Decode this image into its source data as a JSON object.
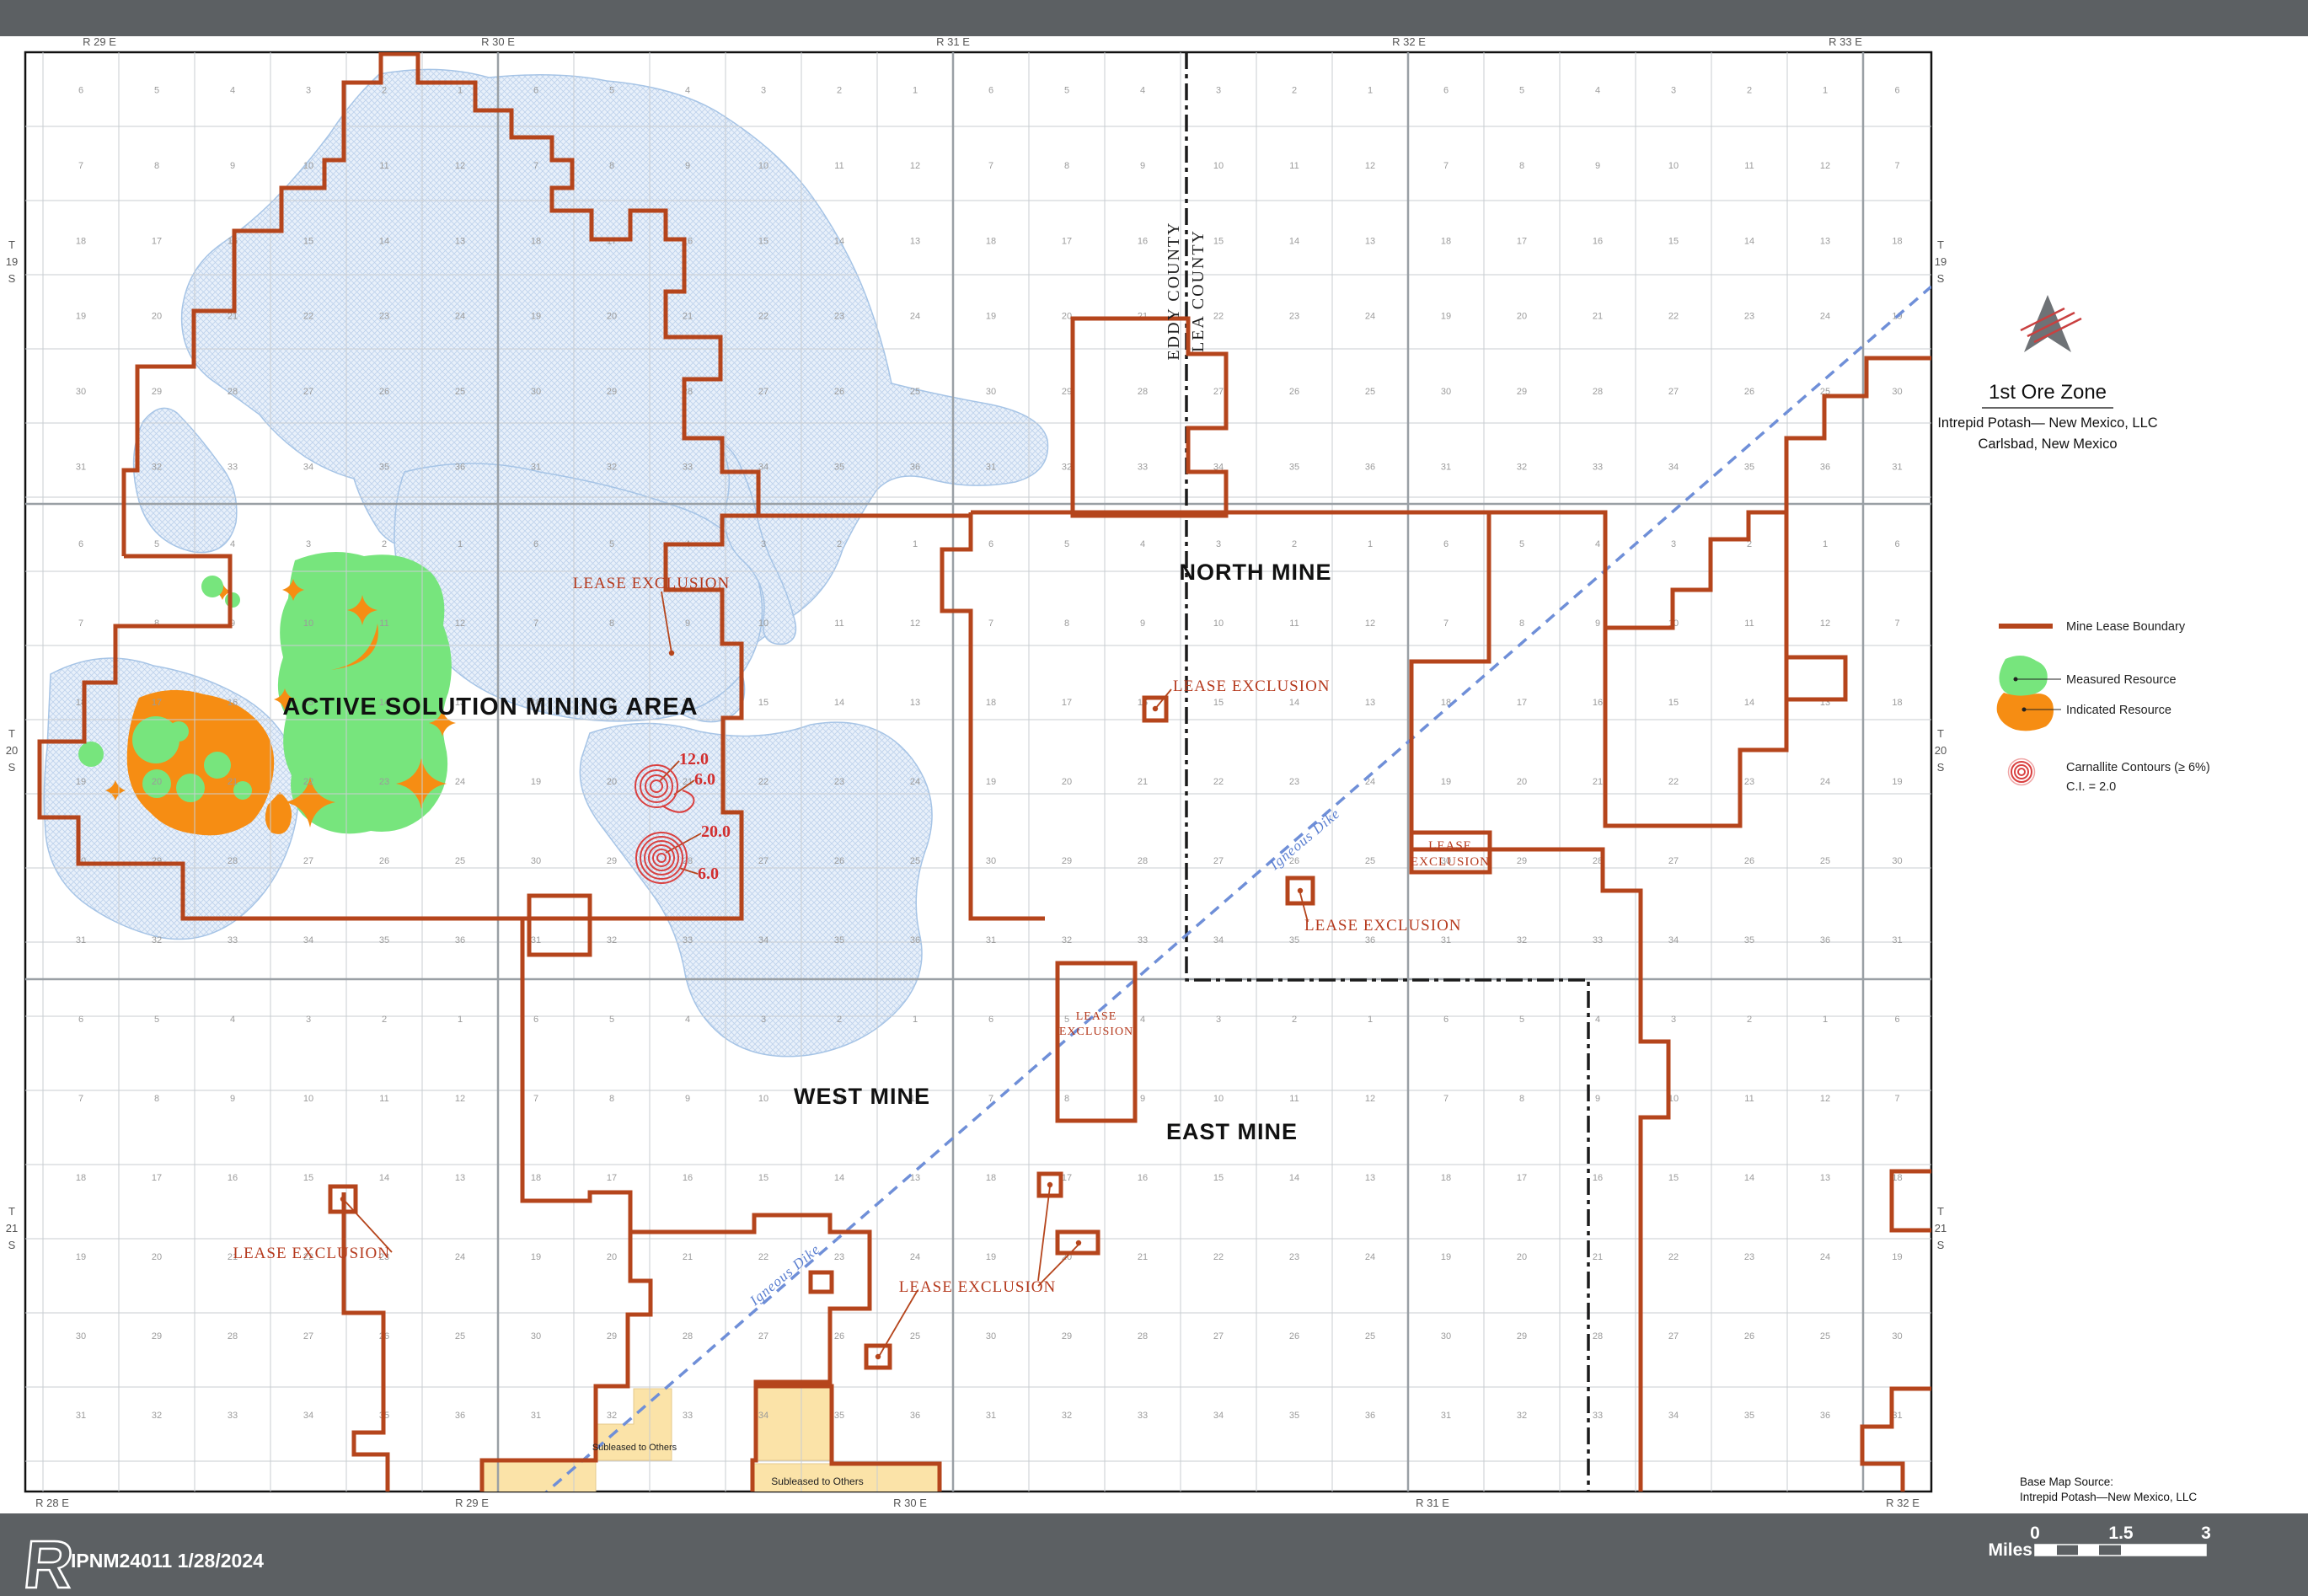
{
  "title_block": {
    "title": "1st Ore Zone",
    "line1": "Intrepid Potash— New Mexico, LLC",
    "line2": "Carlsbad, New Mexico"
  },
  "legend": {
    "mine_lease_boundary": "Mine Lease Boundary",
    "measured_resource": "Measured Resource",
    "indicated_resource": "Indicated Resource",
    "carnallite_line1": "Carnallite Contours (≥ 6%)",
    "carnallite_line2": "C.I. = 2.0"
  },
  "map": {
    "labels": {
      "active_solution": "ACTIVE SOLUTION MINING AREA",
      "north_mine": "NORTH MINE",
      "west_mine": "WEST MINE",
      "east_mine": "EAST MINE",
      "eddy_county": "EDDY COUNTY",
      "lea_county": "LEA COUNTY",
      "igneous_dike": "Igneous Dike",
      "lease_exclusion": "LEASE EXCLUSION",
      "lease_exclusion_boxed_line1": "LEASE",
      "lease_exclusion_boxed_line2": "EXCLUSION",
      "subleased": "Subleased to Others"
    },
    "contours": {
      "c1a": "12.0",
      "c1b": "6.0",
      "c2a": "20.0",
      "c2b": "6.0"
    },
    "ranges_top": [
      "R 29 E",
      "R 30 E",
      "R 31 E",
      "R 32 E",
      "R 33 E"
    ],
    "ranges_top_x": [
      118,
      591,
      1131,
      1672,
      2190
    ],
    "ranges_bottom": [
      "R 28 E",
      "R 29 E",
      "R 30 E",
      "R 31 E",
      "R 32 E"
    ],
    "ranges_bottom_x": [
      62,
      560,
      1080,
      1700,
      2258
    ],
    "townships": [
      [
        "T",
        "19",
        "S"
      ],
      [
        "T",
        "20",
        "S"
      ],
      [
        "T",
        "21",
        "S"
      ]
    ],
    "townships_y": [
      295,
      875,
      1442
    ],
    "plss_rows": [
      [
        6,
        5,
        4,
        3,
        2,
        1
      ],
      [
        7,
        8,
        9,
        10,
        11,
        12
      ],
      [
        18,
        17,
        16,
        15,
        14,
        13
      ],
      [
        19,
        20,
        21,
        22,
        23,
        24
      ],
      [
        30,
        29,
        28,
        27,
        26,
        25
      ],
      [
        31,
        32,
        33,
        34,
        35,
        36
      ]
    ],
    "township_x_bounds": [
      51,
      591,
      1131,
      1671,
      2211,
      2292
    ],
    "township_y_bounds": [
      62,
      598,
      1162,
      1726,
      1770
    ]
  },
  "footer": {
    "doc_number": "IPNM24011 1/28/2024",
    "logo_letter": "R",
    "scale": {
      "unit": "Miles",
      "t0": "0",
      "t1": "1.5",
      "t2": "3"
    }
  },
  "source_note": {
    "line1": "Base Map Source:",
    "line2": "Intrepid Potash—New Mexico, LLC"
  },
  "colors": {
    "lease": "#b5451c",
    "measured": "#77e57d",
    "indicated": "#f68d13",
    "lake_fill": "#e8f0fa",
    "lake_line": "#a6c4e6",
    "dike_blue": "#6f8fd8",
    "bar_gray": "#5c6063",
    "subleased_yellow": "#fbe3a8",
    "contour_red": "#d94040"
  }
}
